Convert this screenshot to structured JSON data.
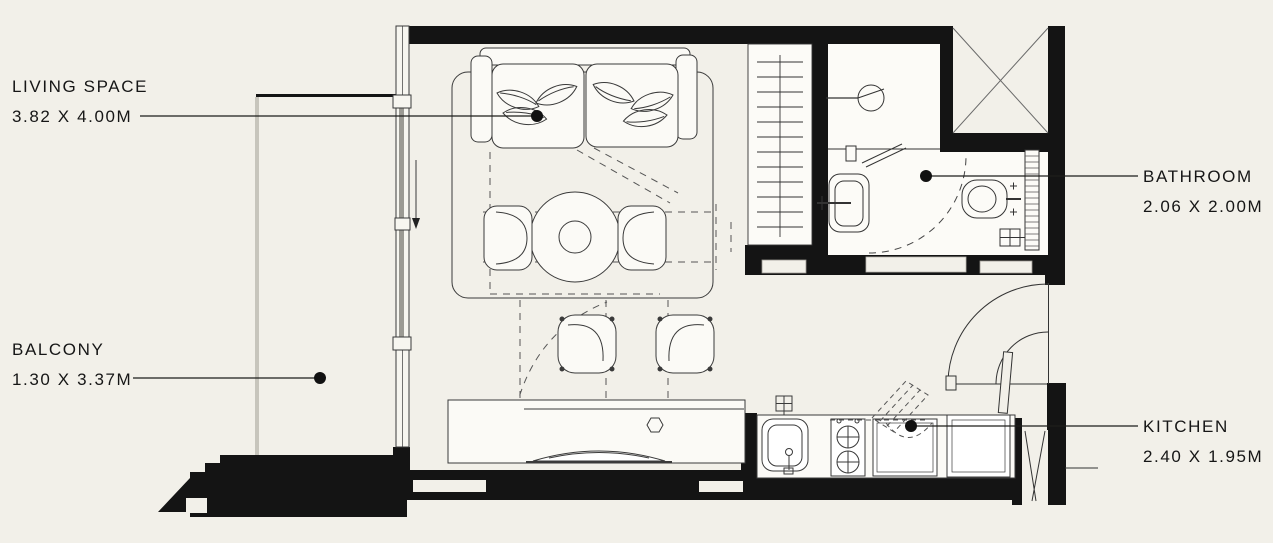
{
  "palette": {
    "background": "#f2f0e9",
    "wall": "#141414",
    "line": "#3a3a3a",
    "furniture_fill": "#fbfaf6",
    "railing_gray": "#c7c5bc",
    "glazing_gray": "#9b9a93"
  },
  "rooms": {
    "living": {
      "name": "LIVING SPACE",
      "dimensions": "3.82 X 4.00M"
    },
    "balcony": {
      "name": "BALCONY",
      "dimensions": "1.30 X 3.37M"
    },
    "bathroom": {
      "name": "BATHROOM",
      "dimensions": "2.06 X 2.00M"
    },
    "kitchen": {
      "name": "KITCHEN",
      "dimensions": "2.40 X 1.95M"
    }
  },
  "symbols": [
    "sofa-bed",
    "pillow-leaves",
    "dining-table",
    "dining-chair",
    "stool",
    "console-table",
    "wardrobe",
    "sliding-door",
    "balcony-railing",
    "shower",
    "washbasin",
    "toilet",
    "floor-drain",
    "towel-rail",
    "entry-door",
    "bathroom-door",
    "service-shaft",
    "duct",
    "kitchen-sink",
    "stove",
    "kitchen-cabinet",
    "fridge",
    "water-point",
    "leader-dot"
  ]
}
